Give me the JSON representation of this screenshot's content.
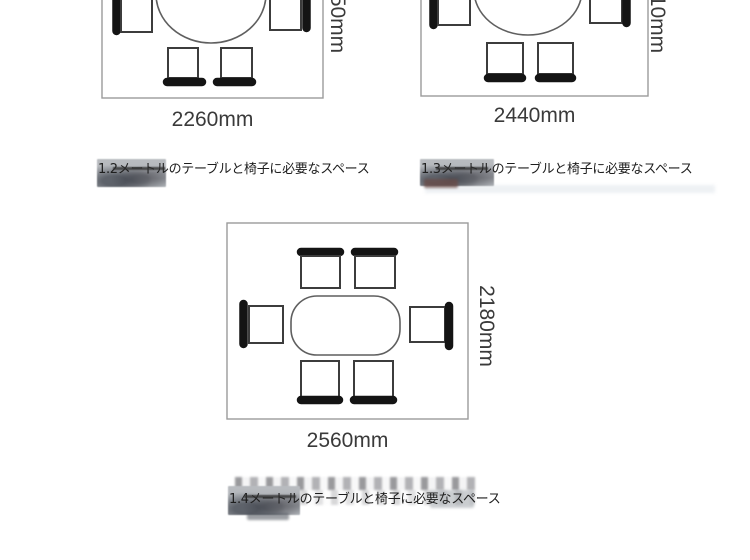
{
  "image_type": "furniture-space-diagram",
  "colors": {
    "background": "#ffffff",
    "boundary_line": "#9b9b9b",
    "table_line": "#5f5f5f",
    "seat_line": "#3c3c3c",
    "backrest": "#141414",
    "dimension_text": "#3a3a3a",
    "caption_text": "#1e1e1e",
    "watermark_gray": "#b0b4b8"
  },
  "diagrams": {
    "d12": {
      "name": "1.2m table layout (cropped at top)",
      "width_label": "2260mm",
      "side_label_visible": "50mm",
      "caption": "1.2メートルのテーブルと椅子に必要なスペース",
      "chairs_visible": 4
    },
    "d13": {
      "name": "1.3m table layout (cropped at top)",
      "width_label": "2440mm",
      "side_label_visible": "10mm",
      "caption": "1.3メートルのテーブルと椅子に必要なスペース",
      "chairs_visible": 4
    },
    "d14": {
      "name": "1.4m table layout",
      "width_label": "2560mm",
      "side_label": "2180mm",
      "caption": "1.4メートルのテーブルと椅子に必要なスペース",
      "chairs_visible": 6
    }
  }
}
